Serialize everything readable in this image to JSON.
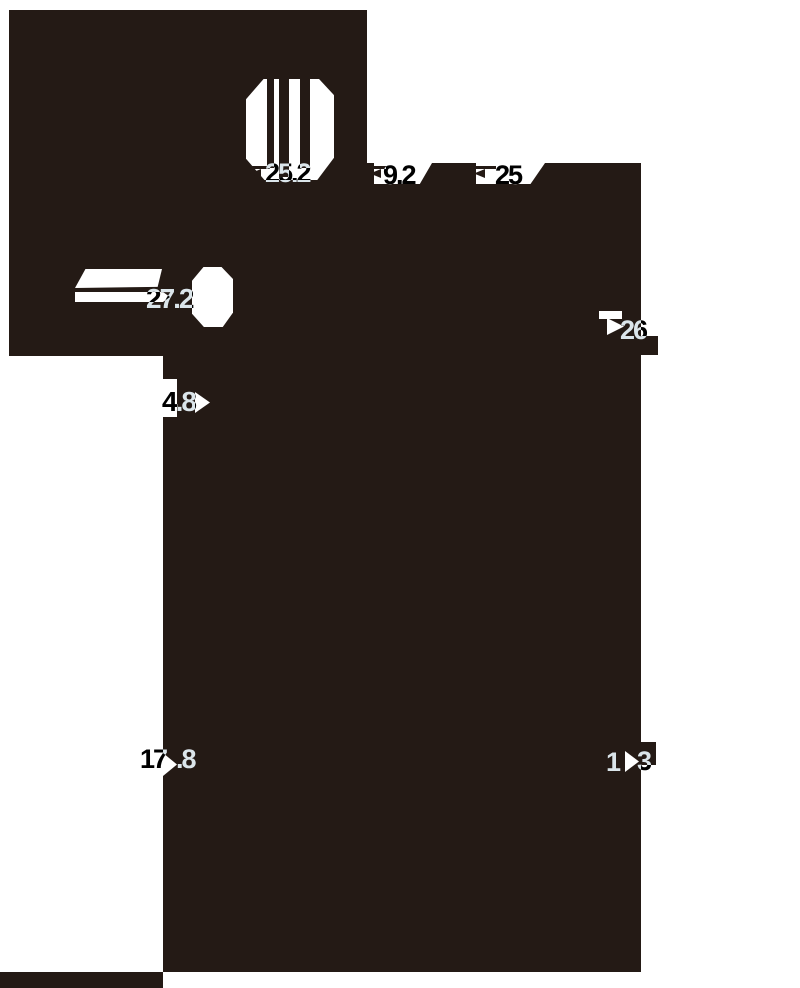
{
  "diagram": {
    "kind": "technical dimension drawing",
    "ink_color": "#241A15",
    "paper_color": "#FFFFFF"
  },
  "dimensions": {
    "slot_plate_width": {
      "value": "25.2"
    },
    "slot_gap": {
      "value": "9.2"
    },
    "slot_pitch": {
      "value": "25"
    },
    "bar_length": {
      "value": "27.2"
    },
    "bar_thickness": {
      "value": "4.8"
    },
    "side_height": {
      "value": "26"
    },
    "body_depth": {
      "value": "17.8",
      "part_a": "17",
      "part_b": ".8"
    },
    "foot_width": {
      "value": "13",
      "part_a": "1",
      "part_b": "3"
    }
  }
}
